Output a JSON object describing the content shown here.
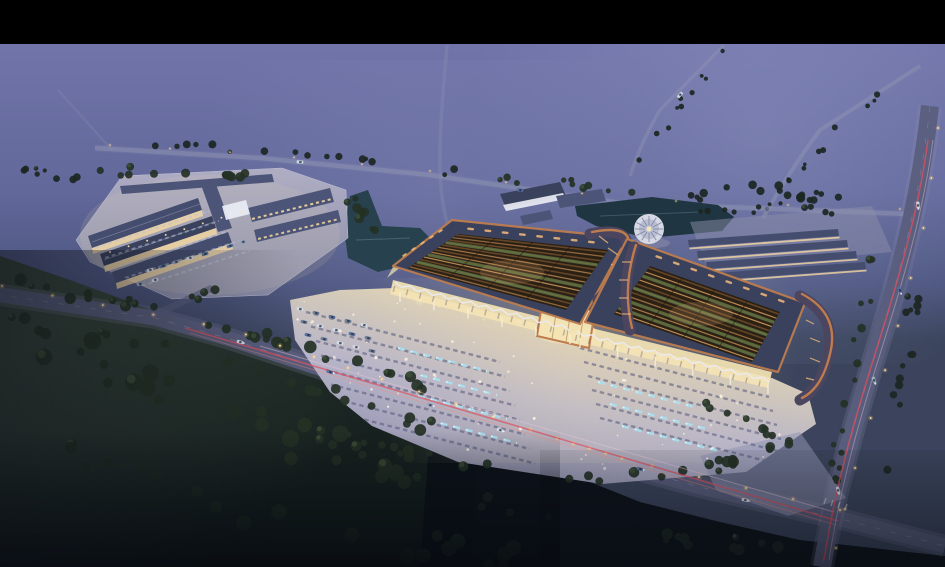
{
  "meta": {
    "subject": "aerial dusk architectural rendering of a market complex with twin pavilions, plaza, campus, ponds and roads",
    "time_of_day": "dusk"
  },
  "canvas": {
    "width": 945,
    "height": 567,
    "letterbox_height": 44
  },
  "palette": {
    "letterbox": "#000000",
    "sky_top": "#7174a9",
    "sky_mid": "#62689a",
    "sky_low": "#4d5680",
    "horizon": "#3b445c",
    "fog": "#9aa0cc",
    "fog2": "#8d92c0",
    "field": "#35433a",
    "field_dark": "#17211f",
    "forest_dark": "#0d1219",
    "tree": "#243125",
    "tree_hi": "#41543a",
    "tree_dim": "#1c2622",
    "road": "#5a5e7d",
    "road_lt": "#9093b2",
    "road_line": "#c9ccdf",
    "lamp_glow": "#ffc878",
    "lamp_core": "#ffe2a8",
    "trail_red": "#e14f5e",
    "trail_red2": "#ff8a74",
    "trail_pink": "#eccadb",
    "headlight": "#eaf2ff",
    "plaza_warm": "#e4d6b2",
    "plaza": "#b7b4c8",
    "plaza_dark": "#8f90ae",
    "pad_light": "#b1afc5",
    "pad": "#8b8da9",
    "roof_slate": "#39415c",
    "roof_band": "#4c5477",
    "slate_blue": "#454d6e",
    "copper": "#bd7c4e",
    "dark_struct": "#2f3650",
    "sail_fill": "#4b4560",
    "lattice_dark": "#2a2014",
    "lattice_beam": "#6b4a2a",
    "lattice_glow": "#f3ba7b",
    "green_roof": "#5f7042",
    "glass_warm": "#f4e3b4",
    "white_struct": "#e9ebf3",
    "pond": "#27424e",
    "pond_dark": "#1f3642",
    "fountain": "#a8e2f2",
    "fountain_core": "#e8fbff",
    "stall": "#53577a",
    "stall_light": "#b9c3d8",
    "car_white": "#d2dce8",
    "car_blue": "#54719e",
    "window_warm": "#f6d8a0"
  },
  "scene": {
    "lattice_slats_left": 14,
    "lattice_slats_right": 12,
    "roof_slots_per_band": 8,
    "plaza_parking_rows_left": 8,
    "plaza_parking_rows_right": 6,
    "fountain_strips_left": 4,
    "fountain_strips_right": 3,
    "campus_parking_rows": 5,
    "warehouse_rows": 4,
    "plaza_point_lights": 60,
    "forest_trees": 60,
    "light_posts_per_wing": 6,
    "cars_in_west_lot": 15,
    "pavilions": 2
  }
}
